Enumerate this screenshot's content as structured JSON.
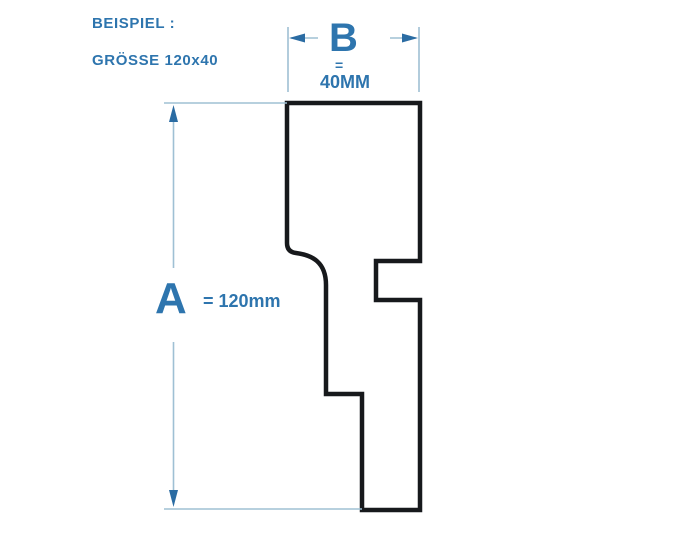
{
  "title": "Profile size example diagram",
  "header": {
    "example_label": "BEISPIEL :",
    "size_label": "GRÖSSE 120x40"
  },
  "dimensions": {
    "width": {
      "letter": "B",
      "equals": "=",
      "value": "40MM"
    },
    "height": {
      "letter": "A",
      "value": "= 120mm"
    }
  },
  "colors": {
    "background": "#ffffff",
    "accent_text": "#2e75ae",
    "dimension_line": "#9fc0d4",
    "arrow": "#2b6ca3",
    "outline": "#17191c"
  }
}
